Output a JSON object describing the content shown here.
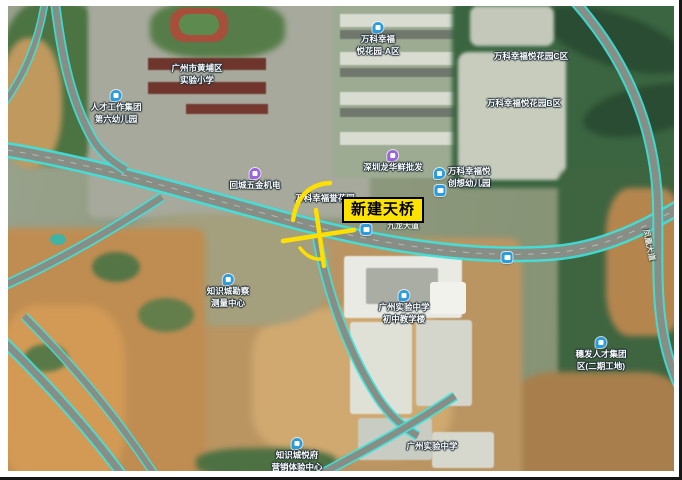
{
  "annotation": {
    "label": "新建天桥"
  },
  "colors": {
    "annotation_bg": "#ffe300",
    "annotation_border": "#000000",
    "sketch": "#ffdf00",
    "road_line": "#3fe2dc",
    "poi_blue": "#2a9ce0",
    "poi_purple": "#9a63e0",
    "label_text": "#ffffff"
  },
  "pois": [
    {
      "id": "talent-kindergarten",
      "icon": "school",
      "x": 116,
      "y": 90,
      "lines": [
        "人才工作集团",
        "第六幼儿园"
      ]
    },
    {
      "id": "huangpu-primary-school",
      "icon": null,
      "x": 197,
      "y": 62,
      "lines": [
        "广州市黄埔区",
        "实验小学"
      ]
    },
    {
      "id": "vanke-garden-a",
      "icon": "residence",
      "x": 378,
      "y": 22,
      "lines": [
        "万科幸福",
        "悦花园-A区"
      ]
    },
    {
      "id": "vanke-garden-c",
      "icon": null,
      "x": 531,
      "y": 50,
      "lines": [
        "万科幸福悦花园C区"
      ]
    },
    {
      "id": "vanke-garden-b",
      "icon": null,
      "x": 524,
      "y": 97,
      "lines": [
        "万科幸福悦花园B区"
      ]
    },
    {
      "id": "hardware-market",
      "icon": "shop",
      "x": 255,
      "y": 168,
      "lines": [
        "回城五金机电"
      ]
    },
    {
      "id": "seafood-market",
      "icon": "shop",
      "x": 393,
      "y": 150,
      "lines": [
        "深圳龙华鲜批发"
      ]
    },
    {
      "id": "vanke-chuangxiang-kindergarten",
      "icon": "school",
      "x": 442,
      "y": 168,
      "side": "right",
      "lines": [
        "万科幸福悦",
        "创想幼儿园"
      ]
    },
    {
      "id": "vanke-garden-label",
      "icon": null,
      "x": 325,
      "y": 192,
      "lines": [
        "万科幸福誉花园"
      ]
    },
    {
      "id": "roadside-stop-west",
      "icon": "transit",
      "x": 440,
      "y": 185,
      "lines": []
    },
    {
      "id": "metro-station",
      "icon": "transit",
      "x": 366,
      "y": 224,
      "lines": []
    },
    {
      "id": "roadside-stop-east",
      "icon": "transit",
      "x": 507,
      "y": 252,
      "lines": []
    },
    {
      "id": "school-junior-building",
      "icon": "building",
      "x": 404,
      "y": 290,
      "lines": [
        "广州实验中学",
        "初中教学楼"
      ]
    },
    {
      "id": "survey-center",
      "icon": "building",
      "x": 228,
      "y": 274,
      "lines": [
        "知识城勘察",
        "测量中心"
      ]
    },
    {
      "id": "yuefu-sales-center",
      "icon": "building",
      "x": 297,
      "y": 438,
      "lines": [
        "知识城悦府",
        "营销体验中心"
      ]
    },
    {
      "id": "experimental-school",
      "icon": null,
      "x": 432,
      "y": 440,
      "lines": [
        "广州实验中学"
      ]
    },
    {
      "id": "suifa-talent-site",
      "icon": "building",
      "x": 601,
      "y": 337,
      "lines": [
        "穗发人才集团",
        "区(二期工地)"
      ]
    }
  ],
  "road_labels": [
    {
      "id": "main-road-name",
      "x": 403,
      "y": 226,
      "rotate": 0,
      "text": "九龙大道"
    },
    {
      "id": "side-road-name",
      "x": 649,
      "y": 245,
      "rotate": 78,
      "text": "凤凰大道"
    }
  ]
}
